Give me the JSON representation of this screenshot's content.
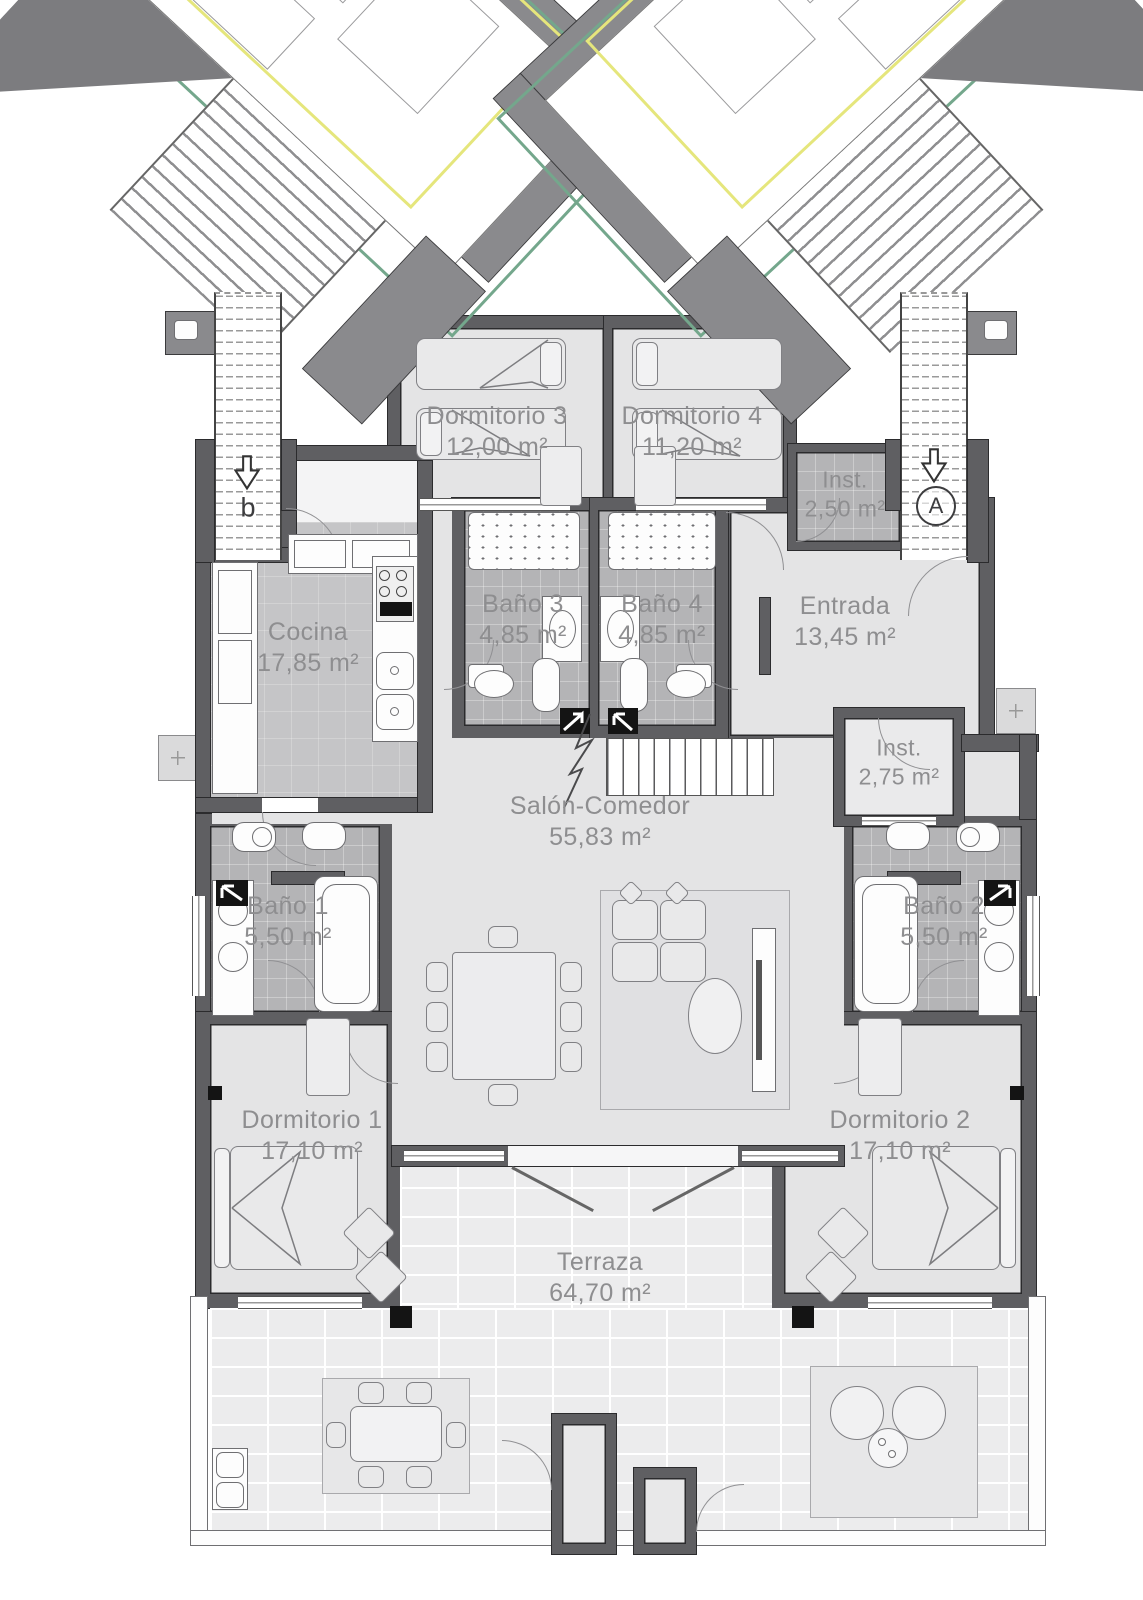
{
  "plan": {
    "rooms": {
      "dormitorio3": {
        "name": "Dormitorio 3",
        "area": "12,00 m²"
      },
      "dormitorio4": {
        "name": "Dormitorio 4",
        "area": "11,20 m²"
      },
      "inst_top": {
        "name": "Inst.",
        "area": "2,50 m²"
      },
      "cocina": {
        "name": "Cocina",
        "area": "17,85 m²"
      },
      "bano3": {
        "name": "Baño 3",
        "area": "4,85 m²"
      },
      "bano4": {
        "name": "Baño 4",
        "area": "4,85 m²"
      },
      "entrada": {
        "name": "Entrada",
        "area": "13,45 m²"
      },
      "inst_right": {
        "name": "Inst.",
        "area": "2,75 m²"
      },
      "salon": {
        "name": "Salón-Comedor",
        "area": "55,83 m²"
      },
      "bano1": {
        "name": "Baño 1",
        "area": "5,50 m²"
      },
      "bano2": {
        "name": "Baño 2",
        "area": "5,50 m²"
      },
      "dormitorio1": {
        "name": "Dormitorio 1",
        "area": "17,10 m²"
      },
      "dormitorio2": {
        "name": "Dormitorio 2",
        "area": "17,10 m²"
      },
      "terraza": {
        "name": "Terraza",
        "area": "64,70 m²"
      }
    },
    "stairwells": {
      "left_letter": "b",
      "right_letter": "A"
    },
    "colors": {
      "wall": "#5f5f62",
      "floor": "#e4e4e5",
      "tile": "#b4b4b6",
      "kitchen": "#c5c5c7",
      "terrace": "#ececed",
      "accent_green": "#74a78c",
      "accent_yellow": "#e5e67c",
      "text": "#8e8e90"
    }
  }
}
